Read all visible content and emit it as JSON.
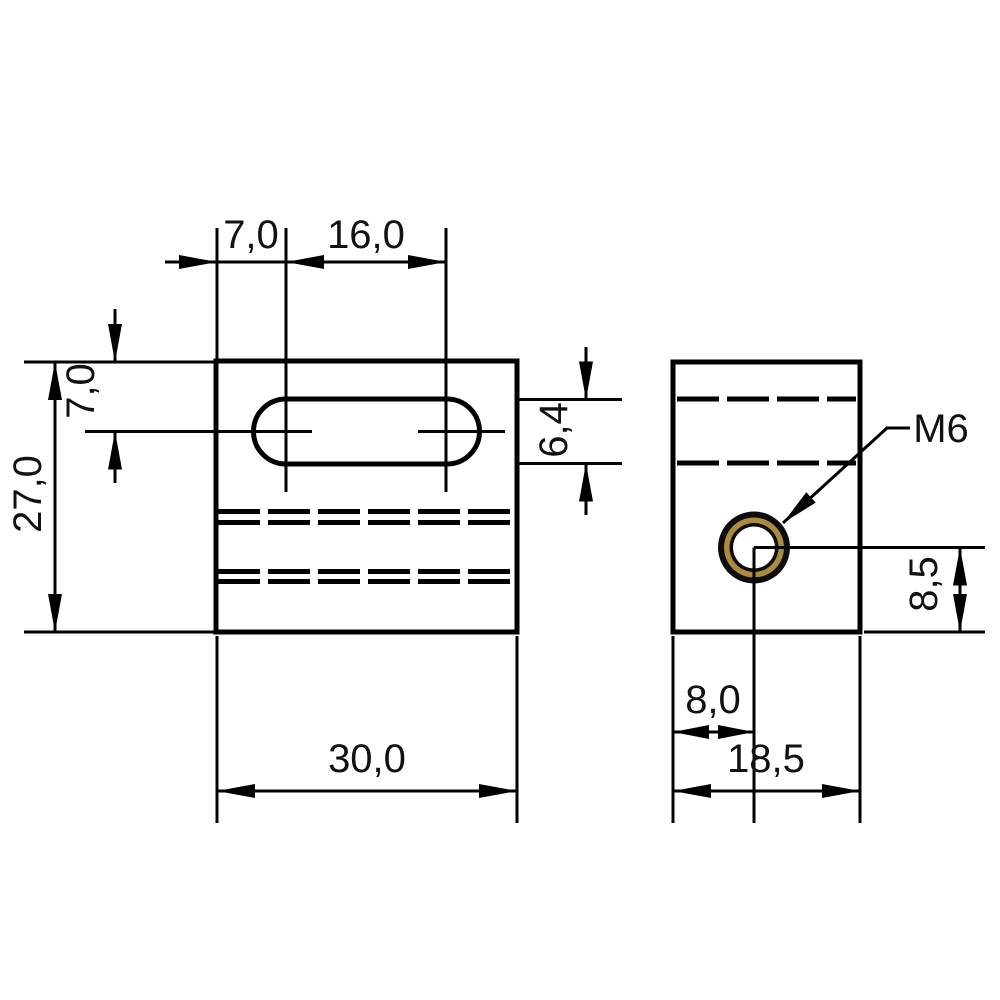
{
  "drawing": {
    "kind": "two-view technical dimension drawing of a slotted mounting block",
    "units_style": "decimal comma, millimetres",
    "front_view": {
      "name": "front view",
      "dims": {
        "slot_center_offset_from_left": "7,0",
        "slot_center_distance": "16,0",
        "plate_height": "27,0",
        "slot_center_offset_from_top": "7,0",
        "slot_width": "6,4",
        "plate_width": "30,0"
      }
    },
    "side_view": {
      "name": "side view",
      "thread_label": "M6",
      "dims": {
        "hole_center_from_bottom": "8,5",
        "hole_center_from_left": "8,0",
        "depth": "18,5"
      }
    },
    "colors": {
      "background": "#ffffff",
      "outline": "#000000",
      "body_light": "#5a6067",
      "body_mid": "#474c52",
      "body_dark": "#373c41",
      "thread_brass": "#aa8b40",
      "hole_fill": "#ffffff"
    }
  }
}
